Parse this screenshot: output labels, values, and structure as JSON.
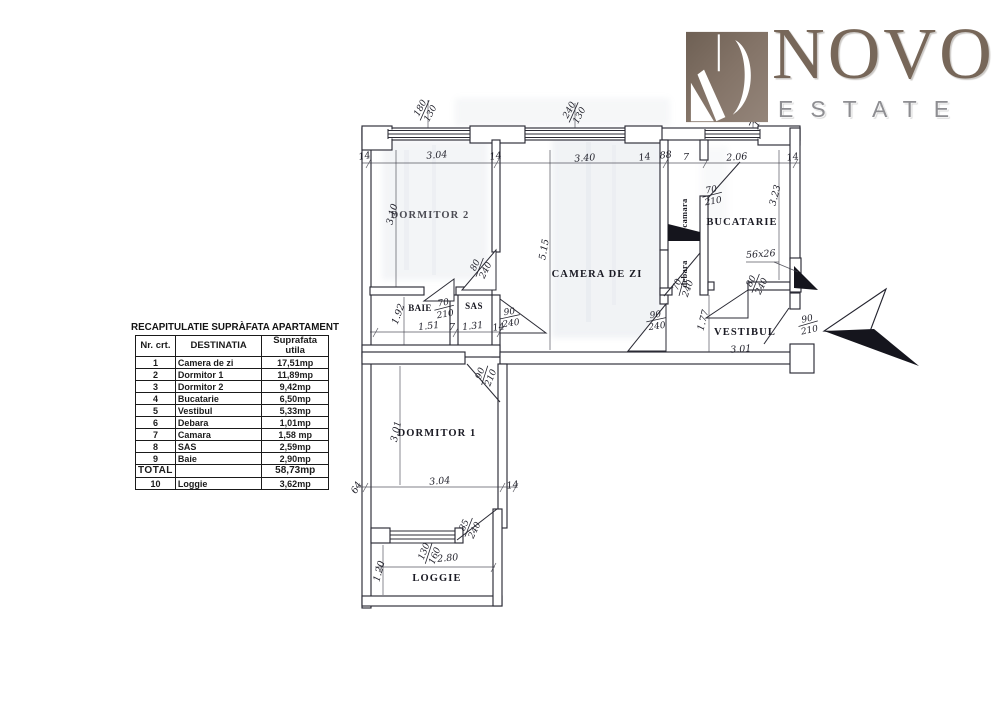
{
  "logo": {
    "name": "NOVO",
    "subtitle": "ESTATE",
    "icon": "novo-monogram",
    "brand_color": "#776759",
    "subtitle_color": "#8e8e92"
  },
  "table": {
    "title": "RECAPITULATIE SUPRÀFATA APARTAMENT",
    "columns": [
      "Nr. crt.",
      "DESTINATIA",
      "Suprafata utila"
    ],
    "rows": [
      [
        "1",
        "Camera de zi",
        "17,51mp"
      ],
      [
        "2",
        "Dormitor 1",
        "11,89mp"
      ],
      [
        "3",
        "Dormitor 2",
        "9,42mp"
      ],
      [
        "4",
        "Bucatarie",
        "6,50mp"
      ],
      [
        "5",
        "Vestibul",
        "5,33mp"
      ],
      [
        "6",
        "Debara",
        "1,01mp"
      ],
      [
        "7",
        "Camara",
        "1,58 mp"
      ],
      [
        "8",
        "SAS",
        "2,59mp"
      ],
      [
        "9",
        "Baie",
        "2,90mp"
      ],
      [
        "TOTAL",
        "",
        "58,73mp"
      ],
      [
        "10",
        "Loggie",
        "3,62mp"
      ]
    ]
  },
  "plan": {
    "rooms": {
      "dormitor2": "DORMITOR 2",
      "camera_de_zi": "CAMERA DE ZI",
      "bucatarie": "BUCATARIE",
      "vestibul": "VESTIBUL",
      "baie": "BAIE",
      "sas": "SAS",
      "camara": "camara",
      "debara": "debara",
      "dormitor1": "DORMITOR 1",
      "loggie": "LOGGIE"
    },
    "dims": {
      "t1": "14",
      "dorm2_w": "3.04",
      "t2": "14",
      "living_w": "3.40",
      "t3": "14",
      "camara_w": "88",
      "t4": "7",
      "kitchen_w": "2.06",
      "t5": "14",
      "dorm2_h": "3.10",
      "living_h": "5.15",
      "kitchen_h": "3.23",
      "baie_h": "1.92",
      "baie_w": "1.51",
      "t6": "7",
      "sas_w": "1.31",
      "t7": "14",
      "vest_h": "1.77",
      "vest_w": "3.01",
      "dorm1_h": "3.01",
      "dorm1_w": "3.04",
      "t8": "64",
      "t9": "14",
      "loggia_w": "2.80",
      "loggia_h": "1.20",
      "duct": "56x26"
    },
    "openings": {
      "win_dorm2": "180/130",
      "win_living": "240/130",
      "win_kitchen": "120/150",
      "door_dorm2": "80/240",
      "door_baie": "70/210",
      "door_sas_living": "90/240",
      "door_dorm1": "90/210",
      "door_camara": "70/210",
      "door_debara": "70/240",
      "door_balcony_kitchen": "80/240",
      "door_living_vestibul": "90/240",
      "door_entrance": "90/210",
      "win_loggia": "130/160",
      "door_loggia": "85/240"
    }
  }
}
